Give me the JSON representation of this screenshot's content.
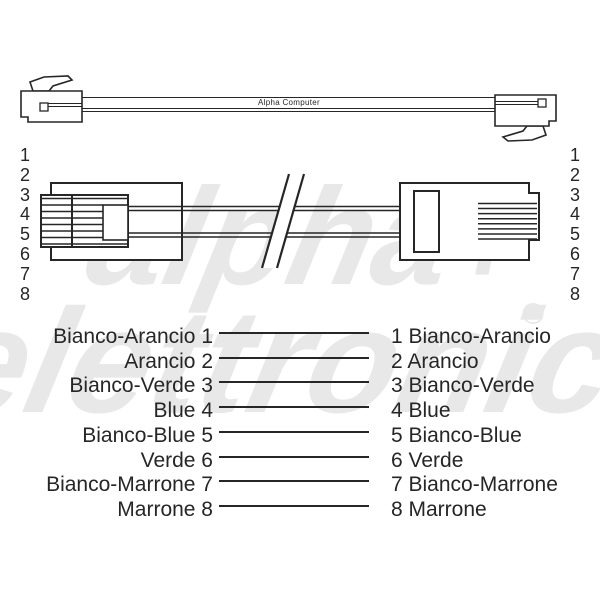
{
  "colors": {
    "ink": "#262626",
    "watermark": "#e8e8e8",
    "background": "#ffffff"
  },
  "top_cable": {
    "label": "Alpha Computer"
  },
  "connector_pins": {
    "left": [
      "1",
      "2",
      "3",
      "4",
      "5",
      "6",
      "7",
      "8"
    ],
    "right": [
      "1",
      "2",
      "3",
      "4",
      "5",
      "6",
      "7",
      "8"
    ]
  },
  "wiring_map": {
    "rows": [
      {
        "left": "Bianco-Arancio 1",
        "right": "1 Bianco-Arancio"
      },
      {
        "left": "Arancio 2",
        "right": "2 Arancio"
      },
      {
        "left": "Bianco-Verde 3",
        "right": "3 Bianco-Verde"
      },
      {
        "left": "Blue 4",
        "right": "4 Blue"
      },
      {
        "left": "Bianco-Blue 5",
        "right": "5 Bianco-Blue"
      },
      {
        "left": "Verde 6",
        "right": "6 Verde"
      },
      {
        "left": "Bianco-Marrone 7",
        "right": "7 Bianco-Marrone"
      },
      {
        "left": "Marrone 8",
        "right": "8 Marrone"
      }
    ]
  },
  "watermark": {
    "line1": "alpha",
    "plus": "+",
    "line2": "elettronica",
    "registered": "®"
  }
}
